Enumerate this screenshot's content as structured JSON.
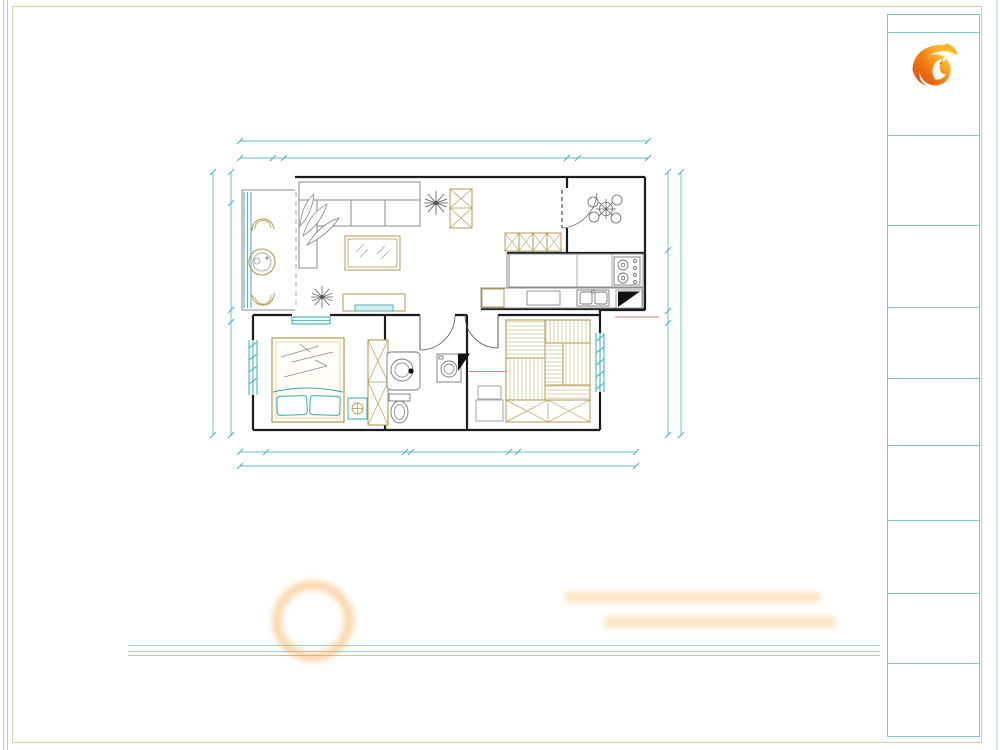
{
  "watermarks": {
    "autodesk": "由 Autodesk 教育版产品制作"
  },
  "plan": {
    "labels": {
      "fridge": "冰箱",
      "small_appliance": "小电器",
      "demolish_flue": "砸掉烟道",
      "keep_duct": "风道勿砸"
    },
    "dims": {
      "top_total": "11560",
      "top": [
        "945",
        "300",
        "8030",
        "300",
        "1985"
      ],
      "left_total": "6355",
      "left": [
        "755",
        "2575",
        "300",
        "2725"
      ],
      "right_total": "6355",
      "right": [
        "1890",
        "1470",
        "300",
        "2695"
      ],
      "bottom_total": "9595",
      "bottom": [
        "640",
        "3355",
        "140",
        "2370",
        "230",
        "2860"
      ]
    }
  },
  "footer": {
    "title": "平面布局图",
    "note": "注：客户需要砸烟道下PVC管，需客户签字后施工(造成一切后果装修公司概不负责）。本图纸家具尺寸均为参考。"
  },
  "titleblock": {
    "company_label": "设计单位.",
    "company_en": "The  Co.",
    "logo_cn": "林凤装饰",
    "logo_en": "Linfeng Decoration",
    "project_label": "工程名称：",
    "project_label_en": "Project Name:",
    "project_name": "龙湖唐宁ONE",
    "project_unit": "15#2-31-1",
    "notes_label": "备  注：",
    "notes_text": "非得本设计师之书面批准，不得转让任何部位翻印和使用。切须图内数字予所示为准，施工单位必须在工地核对图内所示数字之准确，如发现有任何矛盾处，应通知设计师，方可施工。所有施工单位验收标准所有资料。",
    "drawing_label": "图  名：",
    "drawing_name": "平面布局图",
    "client_sign_label": "客户签字确认",
    "designer_label": "设计师姓名  ：",
    "designer_name": "付统",
    "manager_label": "经理签字",
    "audit_label": "审      核",
    "date_label": "打印日期",
    "date_value": "2017-12-15",
    "sheet_label": "图纸页号",
    "sheet_value": "003"
  },
  "colors": {
    "teal_line": "#5fbfbf",
    "tan_line": "#b49a50",
    "dim_text": "#9a914c",
    "brand_orange": "#f08300",
    "border_tan": "#d9cfa4",
    "border_teal": "#7ecaca"
  }
}
